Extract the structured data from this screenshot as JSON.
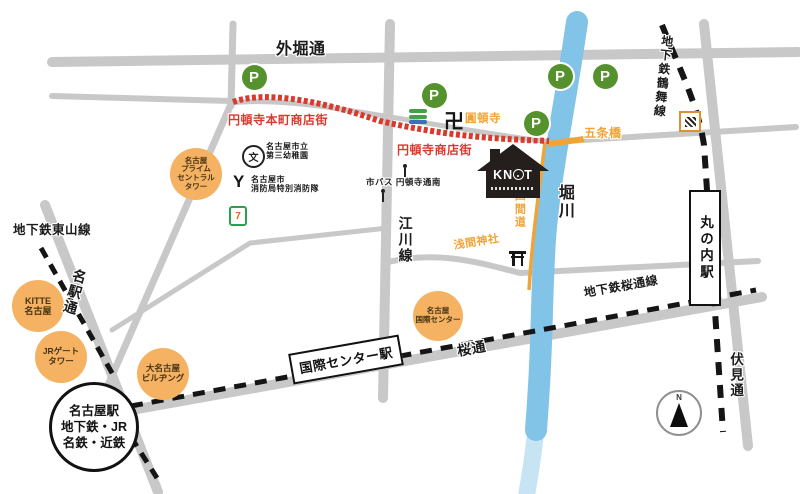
{
  "colors": {
    "road": "#c8c8c8",
    "river": "#82c3e8",
    "shopping_street_red": "#d93a2e",
    "orange": "#f0a437",
    "poi_bg": "#f5b263",
    "parking_green": "#55912d",
    "subway_black": "#151515",
    "arcade_bar_green": "#44a148",
    "arcade_bar_blue": "#3a6ec0"
  },
  "road_labels": [
    {
      "name": "sotobori-dori-label",
      "text": "外堀通",
      "x": 276,
      "y": 41,
      "fs": 16,
      "vertical": false,
      "rot": 0,
      "color": "black"
    },
    {
      "name": "higashiyama-line-label",
      "text": "地下鉄東山線",
      "x": 13,
      "y": 223,
      "fs": 12.5,
      "vertical": false,
      "rot": 0,
      "color": "black"
    },
    {
      "name": "meieki-dori-label",
      "text": "名駅通",
      "x": 73,
      "y": 267,
      "fs": 14,
      "vertical": true,
      "rot": 16,
      "color": "black"
    },
    {
      "name": "egawa-line-label",
      "text": "江川線",
      "x": 397,
      "y": 216,
      "fs": 14,
      "vertical": true,
      "rot": 0,
      "color": "black"
    },
    {
      "name": "horikawa-river-label",
      "text": "堀川",
      "x": 555,
      "y": 184,
      "fs": 16,
      "vertical": true,
      "rot": 0,
      "color": "black"
    },
    {
      "name": "sakura-dori-label",
      "text": "桜通",
      "x": 456,
      "y": 344,
      "fs": 14,
      "vertical": false,
      "rot": -10,
      "color": "black"
    },
    {
      "name": "sakura-dori-line-label",
      "text": "地下鉄桜通線",
      "x": 583,
      "y": 287,
      "fs": 12,
      "vertical": false,
      "rot": -10,
      "color": "black"
    },
    {
      "name": "fushimi-dori-label",
      "text": "伏見通",
      "x": 728,
      "y": 352,
      "fs": 13.5,
      "vertical": true,
      "rot": 0,
      "color": "black"
    },
    {
      "name": "tsurumai-line-label",
      "text": "地下鉄鶴舞線",
      "x": 660,
      "y": 34,
      "fs": 12,
      "vertical": true,
      "rot": 6,
      "color": "black"
    },
    {
      "name": "endoji-honmachi-shotengai-label",
      "text": "円頓寺本町商店街",
      "x": 228,
      "y": 114,
      "fs": 12,
      "vertical": false,
      "rot": 0,
      "color": "red"
    },
    {
      "name": "endoji-shotengai-label",
      "text": "円頓寺商店街",
      "x": 397,
      "y": 144,
      "fs": 12,
      "vertical": false,
      "rot": 0,
      "color": "red"
    },
    {
      "name": "endoji-temple-label",
      "text": "圓頓寺",
      "x": 465,
      "y": 113,
      "fs": 11.5,
      "vertical": false,
      "rot": 0,
      "color": "orange"
    },
    {
      "name": "gojobashi-label",
      "text": "五条橋",
      "x": 584,
      "y": 127,
      "fs": 12,
      "vertical": false,
      "rot": 0,
      "color": "orange"
    },
    {
      "name": "shikemichi-label",
      "text": "四間道",
      "x": 513,
      "y": 190,
      "fs": 11,
      "vertical": true,
      "rot": 0,
      "color": "orange"
    },
    {
      "name": "sengen-shrine-label",
      "text": "浅間神社",
      "x": 453,
      "y": 240,
      "fs": 11,
      "vertical": false,
      "rot": -9,
      "color": "orange"
    },
    {
      "name": "kindergarten-label",
      "text": "名古屋市立\n第三幼稚園",
      "x": 266,
      "y": 143,
      "fs": 8,
      "vertical": false,
      "rot": 0,
      "color": "black"
    },
    {
      "name": "fire-brigade-label",
      "text": "名古屋市\n消防局特別消防隊",
      "x": 251,
      "y": 176,
      "fs": 8,
      "vertical": false,
      "rot": 0,
      "color": "black"
    },
    {
      "name": "bus-stop-label",
      "text": "市バス 円頓寺通南",
      "x": 366,
      "y": 178,
      "fs": 8.5,
      "vertical": false,
      "rot": 0,
      "color": "black"
    }
  ],
  "pois": [
    {
      "name": "poi-nagoya-prime-central-tower",
      "lines": [
        "名古屋",
        "プライム",
        "セントラル",
        "タワー"
      ],
      "cx": 196,
      "cy": 174,
      "r": 26,
      "fs": 7.5
    },
    {
      "name": "poi-kitte-nagoya",
      "lines": [
        "KITTE",
        "名古屋"
      ],
      "cx": 38,
      "cy": 306,
      "r": 26,
      "fs": 9
    },
    {
      "name": "poi-jr-gate-tower",
      "lines": [
        "JRゲート",
        "タワー"
      ],
      "cx": 61,
      "cy": 357,
      "r": 26,
      "fs": 8.5
    },
    {
      "name": "poi-dai-nagoya-building",
      "lines": [
        "大名古屋",
        "ビルヂング"
      ],
      "cx": 163,
      "cy": 374,
      "r": 26,
      "fs": 8.5
    },
    {
      "name": "poi-nagoya-international-center",
      "lines": [
        "名古屋",
        "国際センター"
      ],
      "cx": 438,
      "cy": 316,
      "r": 25,
      "fs": 7.5
    }
  ],
  "parking": {
    "letter": "P",
    "spots": [
      [
        254,
        77
      ],
      [
        434,
        95
      ],
      [
        536,
        123
      ],
      [
        560,
        76
      ],
      [
        605,
        76
      ]
    ]
  },
  "stations": {
    "nagoya": {
      "lines": [
        "名古屋駅",
        "地下鉄・JR",
        "名鉄・近鉄"
      ]
    },
    "kokusai": {
      "text": "国際センター駅"
    },
    "marunouchi": {
      "text": "丸の内駅"
    }
  },
  "knot": {
    "left": "KN",
    "right": "T"
  },
  "icons": {
    "manji": "卍",
    "school": "文",
    "fire": "Y",
    "seven": "7",
    "compass_north": "N"
  }
}
